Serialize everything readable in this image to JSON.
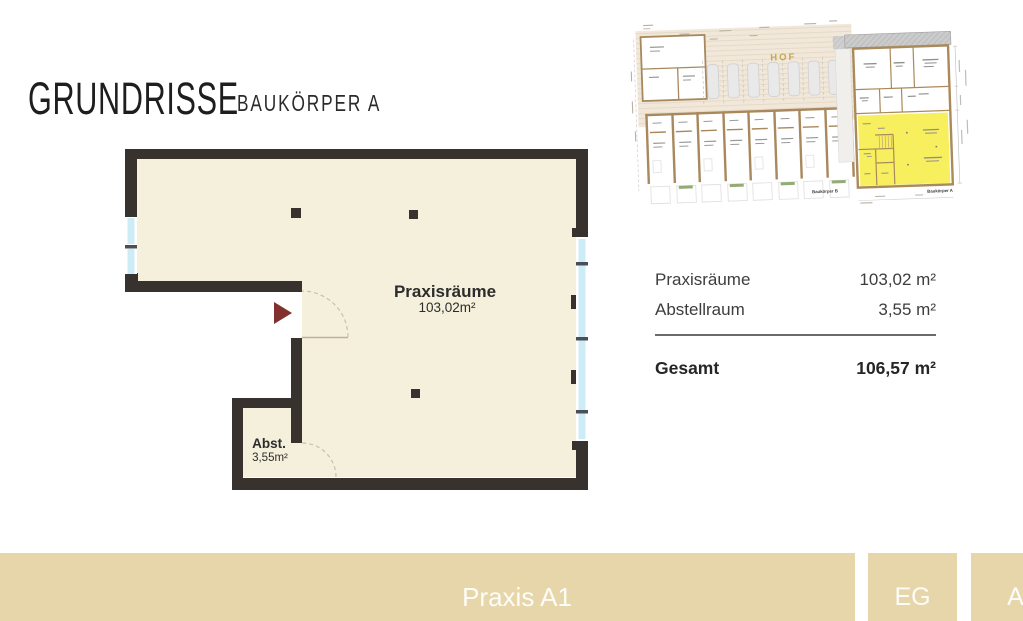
{
  "title": {
    "main": "GRUNDRISSE",
    "sub": "BAUKÖRPER A"
  },
  "floorplan": {
    "praxis_label": "Praxisräume",
    "praxis_area": "103,02m²",
    "abstellraum_label": "Abst.",
    "abstellraum_area": "3,55m²",
    "colors": {
      "floor": "#f5f0dc",
      "wall": "#37322e",
      "window": "#cdecf5",
      "entrance_arrow": "#82302d"
    }
  },
  "siteplan": {
    "hof_label": "HOF",
    "baukoerper_b_label": "Baukörper B",
    "baukoerper_a_label": "Baukörper A",
    "highlight_color": "#f8ef5f"
  },
  "table": {
    "rows": [
      {
        "label": "Praxisräume",
        "value": "103,02 m²"
      },
      {
        "label": "Abstellraum",
        "value": "3,55 m²"
      }
    ],
    "total_label": "Gesamt",
    "total_value": "106,57 m²"
  },
  "footer": {
    "title": "Praxis A1",
    "floor": "EG",
    "building": "A",
    "bar_color": "#e7d6aa"
  }
}
